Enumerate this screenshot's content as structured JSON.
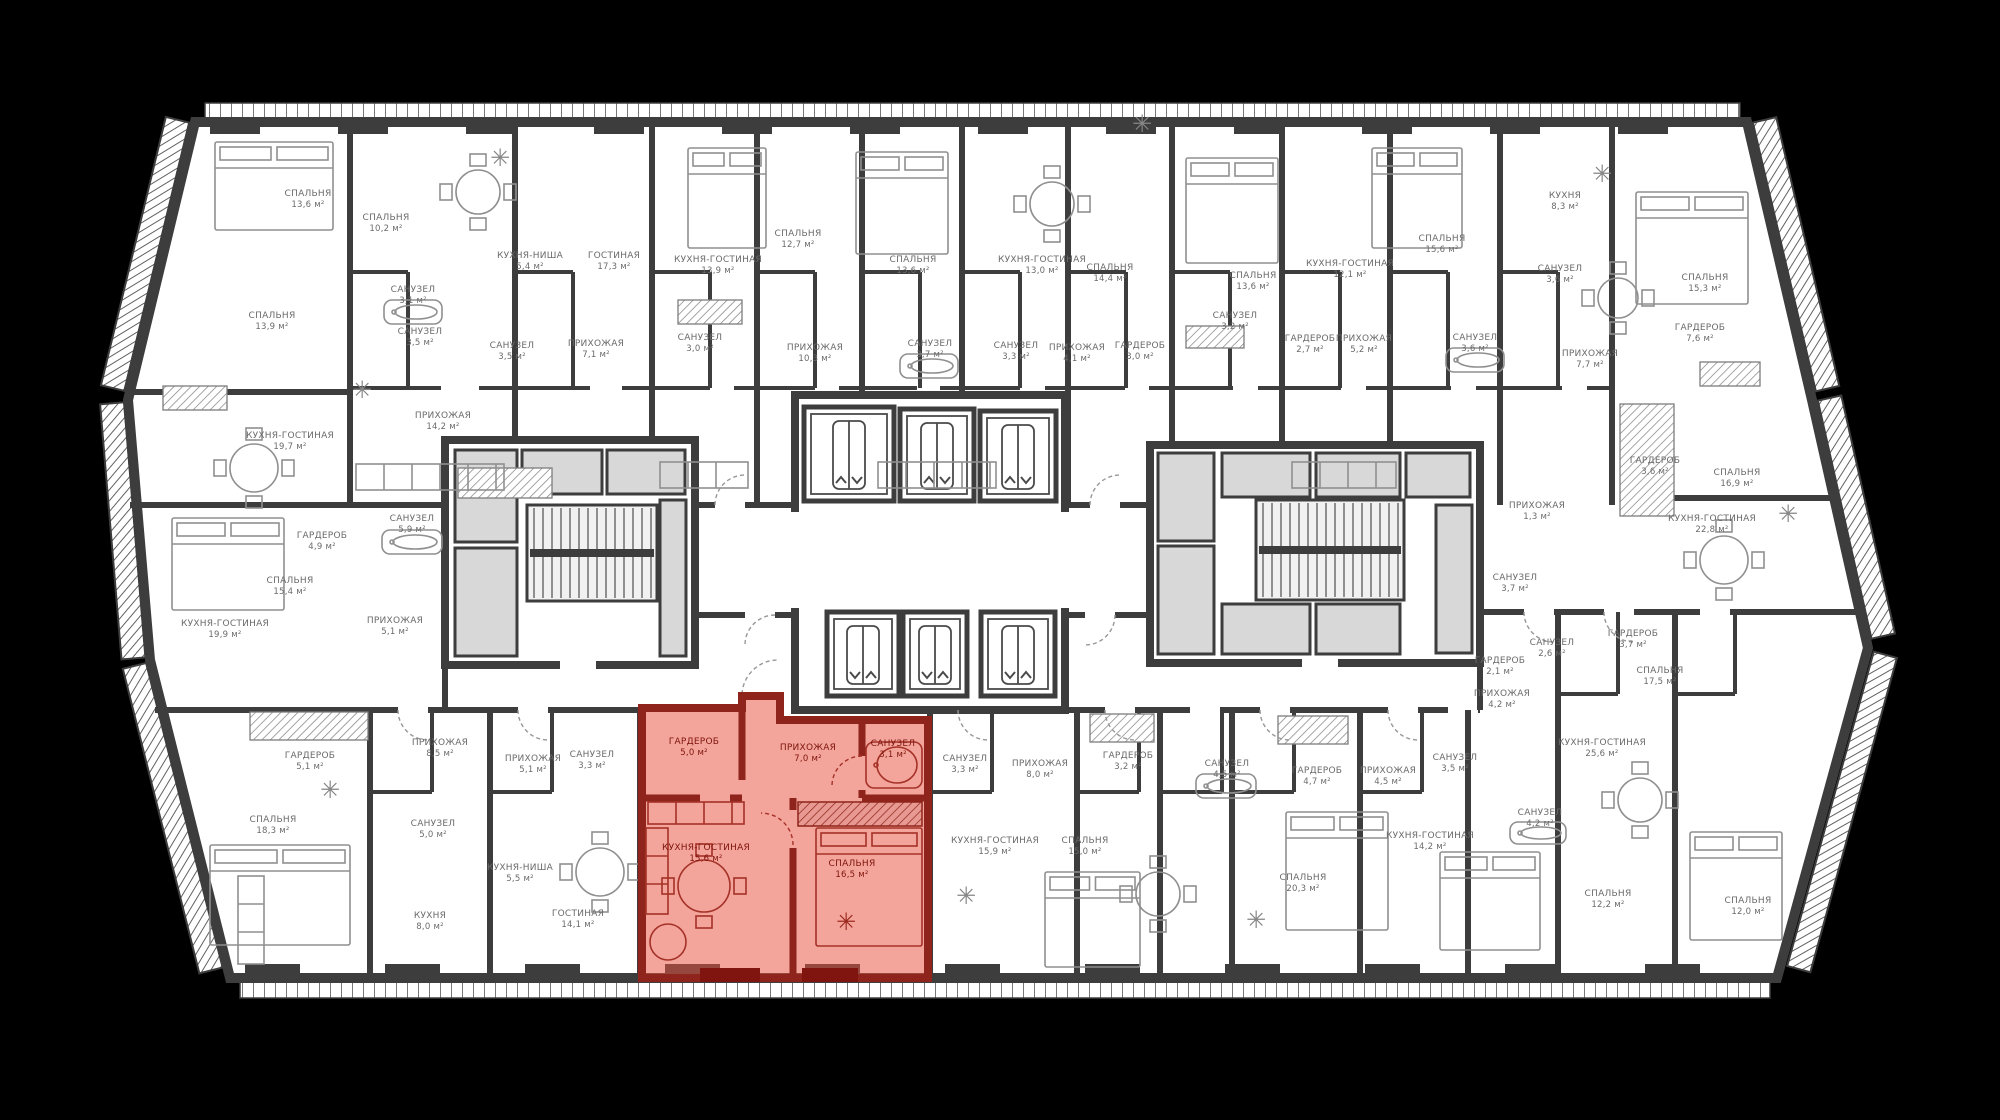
{
  "palette": {
    "background": "#000000",
    "wall": "#3d3d3d",
    "plan_fill": "#ffffff",
    "shaft": "#d8d8d8",
    "furniture": "#8f8f8f",
    "label": "#6a6a6a",
    "highlight_fill": "#e8503f",
    "highlight_wall": "#8e241b",
    "highlight_label": "#7e150c"
  },
  "rooms": [
    {
      "name": "СПАЛЬНЯ",
      "area": "13,6 м²",
      "x": 308,
      "y": 196
    },
    {
      "name": "СПАЛЬНЯ",
      "area": "10,2 м²",
      "x": 386,
      "y": 220
    },
    {
      "name": "КУХНЯ-НИША",
      "area": "5,4 м²",
      "x": 530,
      "y": 258
    },
    {
      "name": "ГОСТИНАЯ",
      "area": "17,3 м²",
      "x": 614,
      "y": 258
    },
    {
      "name": "СПАЛЬНЯ",
      "area": "13,9 м²",
      "x": 272,
      "y": 318
    },
    {
      "name": "САНУЗЕЛ",
      "area": "3,1 м²",
      "x": 413,
      "y": 292
    },
    {
      "name": "САНУЗЕЛ",
      "area": "3,5 м²",
      "x": 420,
      "y": 334
    },
    {
      "name": "САНУЗЕЛ",
      "area": "3,5 м²",
      "x": 512,
      "y": 348
    },
    {
      "name": "ПРИХОЖАЯ",
      "area": "7,1 м²",
      "x": 596,
      "y": 346
    },
    {
      "name": "КУХНЯ-ГОСТИНАЯ",
      "area": "13,9 м²",
      "x": 718,
      "y": 262
    },
    {
      "name": "САНУЗЕЛ",
      "area": "3,0 м²",
      "x": 700,
      "y": 340
    },
    {
      "name": "СПАЛЬНЯ",
      "area": "12,7 м²",
      "x": 798,
      "y": 236
    },
    {
      "name": "ПРИХОЖАЯ",
      "area": "10,3 м²",
      "x": 815,
      "y": 350
    },
    {
      "name": "СПАЛЬНЯ",
      "area": "13,6 м²",
      "x": 913,
      "y": 262
    },
    {
      "name": "САНУЗЕЛ",
      "area": "3,7 м²",
      "x": 930,
      "y": 346
    },
    {
      "name": "КУХНЯ-ГОСТИНАЯ",
      "area": "13,0 м²",
      "x": 1042,
      "y": 262
    },
    {
      "name": "САНУЗЕЛ",
      "area": "3,3 м²",
      "x": 1016,
      "y": 348
    },
    {
      "name": "ПРИХОЖАЯ",
      "area": "4,1 м²",
      "x": 1077,
      "y": 350
    },
    {
      "name": "СПАЛЬНЯ",
      "area": "14,4 м²",
      "x": 1110,
      "y": 270
    },
    {
      "name": "ГАРДЕРОБ",
      "area": "3,0 м²",
      "x": 1140,
      "y": 348
    },
    {
      "name": "СПАЛЬНЯ",
      "area": "13,6 м²",
      "x": 1253,
      "y": 278
    },
    {
      "name": "САНУЗЕЛ",
      "area": "3,2 м²",
      "x": 1235,
      "y": 318
    },
    {
      "name": "КУХНЯ-ГОСТИНАЯ",
      "area": "12,1 м²",
      "x": 1350,
      "y": 266
    },
    {
      "name": "ГАРДЕРОБ",
      "area": "2,7 м²",
      "x": 1310,
      "y": 341
    },
    {
      "name": "ПРИХОЖАЯ",
      "area": "5,2 м²",
      "x": 1364,
      "y": 341
    },
    {
      "name": "СПАЛЬНЯ",
      "area": "15,6 м²",
      "x": 1442,
      "y": 241
    },
    {
      "name": "САНУЗЕЛ",
      "area": "3,6 м²",
      "x": 1475,
      "y": 340
    },
    {
      "name": "КУХНЯ",
      "area": "8,3 м²",
      "x": 1565,
      "y": 198
    },
    {
      "name": "САНУЗЕЛ",
      "area": "3,6 м²",
      "x": 1560,
      "y": 271
    },
    {
      "name": "СПАЛЬНЯ",
      "area": "15,3 м²",
      "x": 1705,
      "y": 280
    },
    {
      "name": "ГАРДЕРОБ",
      "area": "7,6 м²",
      "x": 1700,
      "y": 330
    },
    {
      "name": "ПРИХОЖАЯ",
      "area": "7,7 м²",
      "x": 1590,
      "y": 356
    },
    {
      "name": "КУХНЯ-ГОСТИНАЯ",
      "area": "19,7 м²",
      "x": 290,
      "y": 438
    },
    {
      "name": "ПРИХОЖАЯ",
      "area": "14,2 м²",
      "x": 443,
      "y": 418
    },
    {
      "name": "ГАРДЕРОБ",
      "area": "4,9 м²",
      "x": 322,
      "y": 538
    },
    {
      "name": "САНУЗЕЛ",
      "area": "5,9 м²",
      "x": 412,
      "y": 521
    },
    {
      "name": "СПАЛЬНЯ",
      "area": "15,4 м²",
      "x": 290,
      "y": 583
    },
    {
      "name": "ПРИХОЖАЯ",
      "area": "5,1 м²",
      "x": 395,
      "y": 623
    },
    {
      "name": "КУХНЯ-ГОСТИНАЯ",
      "area": "19,9 м²",
      "x": 225,
      "y": 626
    },
    {
      "name": "ГАРДЕРОБ",
      "area": "3,6 м²",
      "x": 1655,
      "y": 463
    },
    {
      "name": "СПАЛЬНЯ",
      "area": "16,9 м²",
      "x": 1737,
      "y": 475
    },
    {
      "name": "КУХНЯ-ГОСТИНАЯ",
      "area": "22,8 м²",
      "x": 1712,
      "y": 521
    },
    {
      "name": "ПРИХОЖАЯ",
      "area": "1,3 м²",
      "x": 1537,
      "y": 508
    },
    {
      "name": "САНУЗЕЛ",
      "area": "3,7 м²",
      "x": 1515,
      "y": 580
    },
    {
      "name": "САНУЗЕЛ",
      "area": "2,6 м²",
      "x": 1552,
      "y": 645
    },
    {
      "name": "ГАРДЕРОБ",
      "area": "2,1 м²",
      "x": 1500,
      "y": 663
    },
    {
      "name": "ГАРДЕРОБ",
      "area": "3,7 м²",
      "x": 1633,
      "y": 636
    },
    {
      "name": "СПАЛЬНЯ",
      "area": "17,5 м²",
      "x": 1660,
      "y": 673
    },
    {
      "name": "ГАРДЕРОБ",
      "area": "5,1 м²",
      "x": 310,
      "y": 758
    },
    {
      "name": "ПРИХОЖАЯ",
      "area": "8,5 м²",
      "x": 440,
      "y": 745
    },
    {
      "name": "СПАЛЬНЯ",
      "area": "18,3 м²",
      "x": 273,
      "y": 822
    },
    {
      "name": "САНУЗЕЛ",
      "area": "5,0 м²",
      "x": 433,
      "y": 826
    },
    {
      "name": "КУХНЯ",
      "area": "8,0 м²",
      "x": 430,
      "y": 918
    },
    {
      "name": "ПРИХОЖАЯ",
      "area": "5,1 м²",
      "x": 533,
      "y": 761
    },
    {
      "name": "САНУЗЕЛ",
      "area": "3,3 м²",
      "x": 592,
      "y": 757
    },
    {
      "name": "КУХНЯ-НИША",
      "area": "5,5 м²",
      "x": 520,
      "y": 870
    },
    {
      "name": "ГОСТИНАЯ",
      "area": "14,1 м²",
      "x": 578,
      "y": 916
    },
    {
      "name": "САНУЗЕЛ",
      "area": "3,3 м²",
      "x": 965,
      "y": 761
    },
    {
      "name": "ПРИХОЖАЯ",
      "area": "8,0 м²",
      "x": 1040,
      "y": 766
    },
    {
      "name": "ГАРДЕРОБ",
      "area": "3,2 м²",
      "x": 1128,
      "y": 758
    },
    {
      "name": "КУХНЯ-ГОСТИНАЯ",
      "area": "15,9 м²",
      "x": 995,
      "y": 843
    },
    {
      "name": "СПАЛЬНЯ",
      "area": "15,0 м²",
      "x": 1085,
      "y": 843
    },
    {
      "name": "САНУЗЕЛ",
      "area": "4,5 м²",
      "x": 1227,
      "y": 766
    },
    {
      "name": "ГАРДЕРОБ",
      "area": "4,7 м²",
      "x": 1317,
      "y": 773
    },
    {
      "name": "СПАЛЬНЯ",
      "area": "20,3 м²",
      "x": 1303,
      "y": 880
    },
    {
      "name": "ПРИХОЖАЯ",
      "area": "4,2 м²",
      "x": 1502,
      "y": 696
    },
    {
      "name": "САНУЗЕЛ",
      "area": "3,5 м²",
      "x": 1455,
      "y": 760
    },
    {
      "name": "ПРИХОЖАЯ",
      "area": "4,5 м²",
      "x": 1388,
      "y": 773
    },
    {
      "name": "КУХНЯ-ГОСТИНАЯ",
      "area": "25,6 м²",
      "x": 1602,
      "y": 745
    },
    {
      "name": "КУХНЯ-ГОСТИНАЯ",
      "area": "14,2 м²",
      "x": 1430,
      "y": 838
    },
    {
      "name": "САНУЗЕЛ",
      "area": "4,2 м²",
      "x": 1540,
      "y": 815
    },
    {
      "name": "СПАЛЬНЯ",
      "area": "12,2 м²",
      "x": 1608,
      "y": 896
    },
    {
      "name": "СПАЛЬНЯ",
      "area": "12,0 м²",
      "x": 1748,
      "y": 903
    }
  ],
  "highlight_rooms": [
    {
      "name": "ГАРДЕРОБ",
      "area": "5,0 м²",
      "x": 694,
      "y": 744
    },
    {
      "name": "ПРИХОЖАЯ",
      "area": "7,0 м²",
      "x": 808,
      "y": 750
    },
    {
      "name": "САНУЗЕЛ",
      "area": "3,1 м²",
      "x": 893,
      "y": 746
    },
    {
      "name": "КУХНЯ-ГОСТИНАЯ",
      "area": "15,6 м²",
      "x": 706,
      "y": 850
    },
    {
      "name": "СПАЛЬНЯ",
      "area": "16,5 м²",
      "x": 852,
      "y": 866
    }
  ]
}
